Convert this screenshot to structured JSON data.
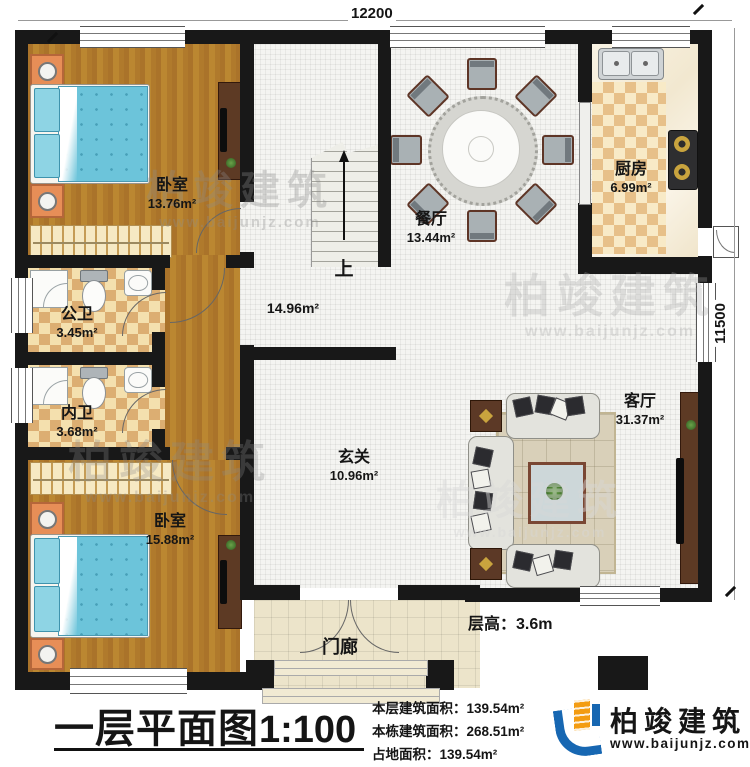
{
  "dimensions": {
    "top": "12200",
    "right": "11500"
  },
  "rooms": [
    {
      "name": "卧室",
      "area": "13.76m²"
    },
    {
      "name": "餐厅",
      "area": "13.44m²"
    },
    {
      "name": "厨房",
      "area": "6.99m²"
    },
    {
      "name": "公卫",
      "area": "3.45m²"
    },
    {
      "name": "内卫",
      "area": "3.68m²"
    },
    {
      "name": "",
      "area": "14.96m²"
    },
    {
      "name": "玄关",
      "area": "10.96m²"
    },
    {
      "name": "卧室",
      "area": "15.88m²"
    },
    {
      "name": "客厅",
      "area": "31.37m²"
    },
    {
      "name": "门廊",
      "area": ""
    }
  ],
  "stairs": {
    "up": "上"
  },
  "notes": {
    "floor_height": "层高：3.6m"
  },
  "footer": {
    "title": "一层平面图",
    "scale": "1:100",
    "stats": [
      {
        "label": "本层建筑面积：",
        "value": "139.54m²"
      },
      {
        "label": "本栋建筑面积：",
        "value": "268.51m²"
      },
      {
        "label": "占地面积：",
        "value": "139.54m²"
      }
    ],
    "brand": {
      "name": "柏竣建筑",
      "url": "www.baijunjz.com"
    }
  },
  "watermark": {
    "name": "柏竣建筑",
    "url": "www.baijunjz.com"
  },
  "colors": {
    "wall": "#181818",
    "wood": "#b5812f",
    "bed_blue": "#6cc4da",
    "checker_tan": "#dcae72",
    "brand_blue": "#1767b2",
    "brand_orange": "#f39c12"
  }
}
